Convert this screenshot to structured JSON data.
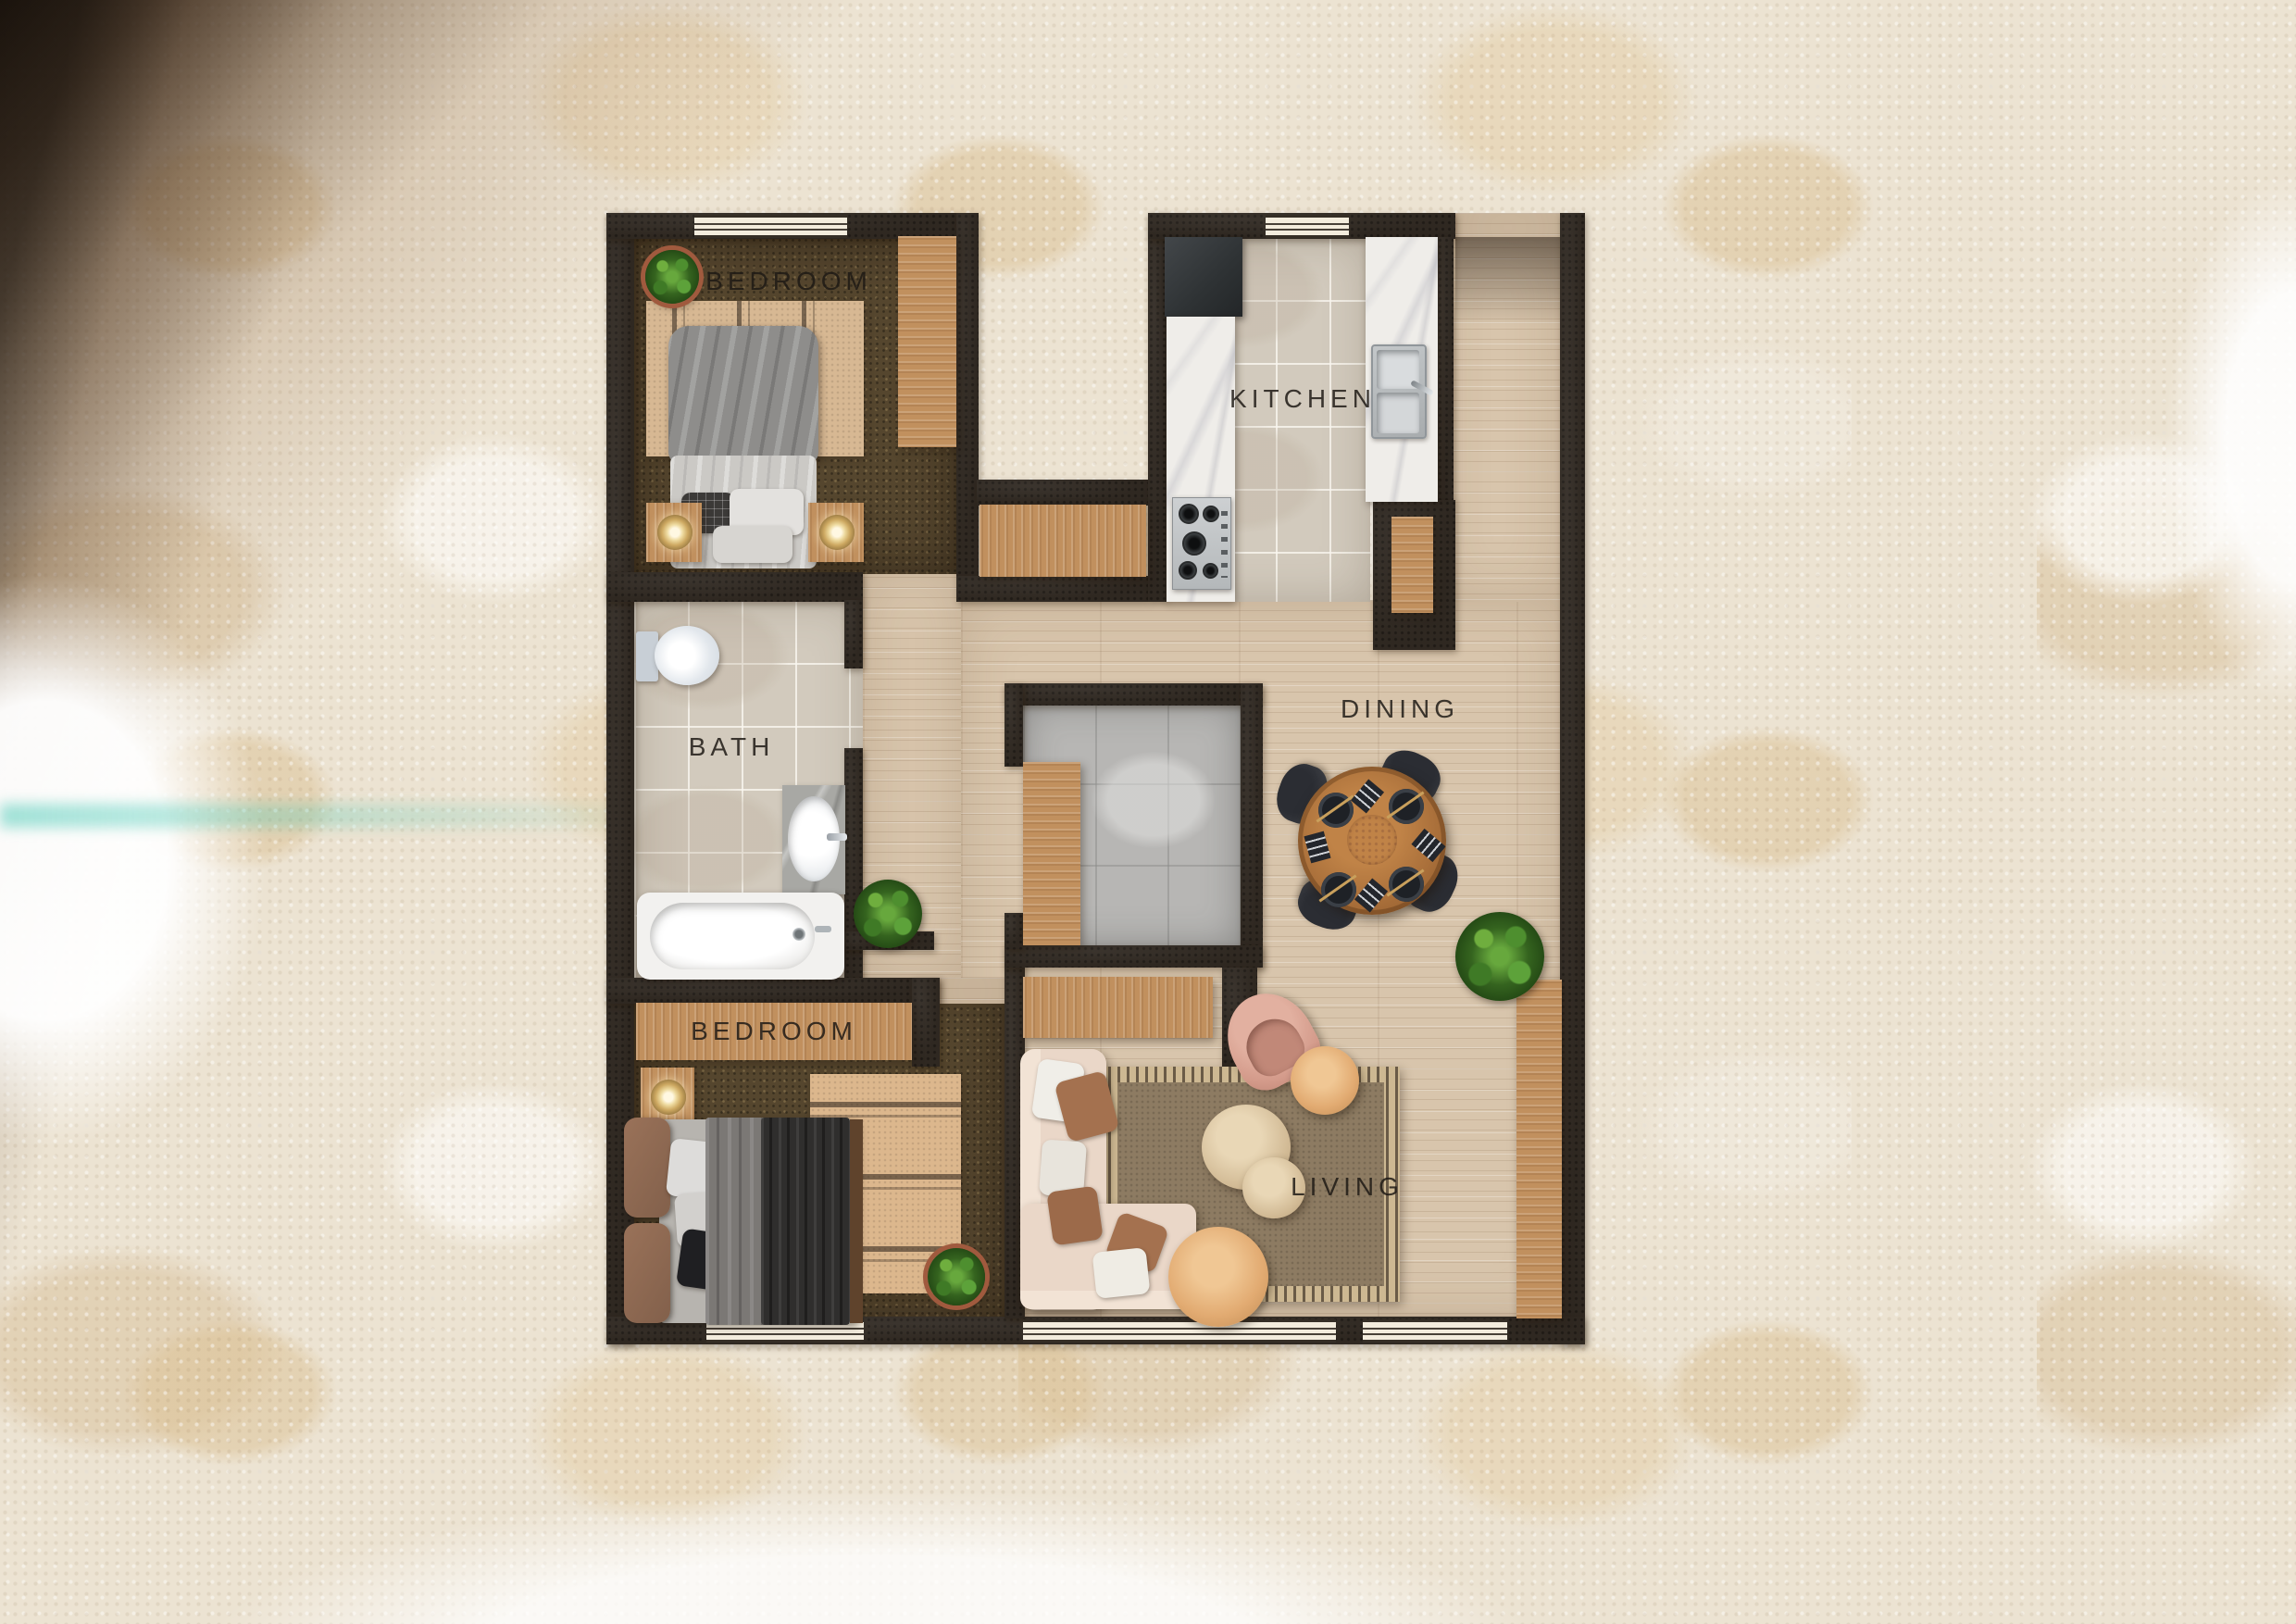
{
  "plan": {
    "type": "apartment-floor-plan-top-view",
    "rooms": [
      {
        "id": "bedroom-top",
        "label": "BEDROOM",
        "floor": "dark-woven-carpet",
        "furniture": [
          "double-bed",
          "zigzag-area-rug",
          "nightstand-left",
          "nightstand-right",
          "table-lamp-left",
          "table-lamp-right",
          "tall-wardrobe",
          "potted-plant"
        ]
      },
      {
        "id": "kitchen",
        "label": "KITCHEN",
        "floor": "stone-tile",
        "furniture": [
          "refrigerator",
          "marble-counter",
          "gas-stove",
          "island-counter",
          "double-sink",
          "base-cabinet"
        ]
      },
      {
        "id": "bath",
        "label": "BATH",
        "floor": "stone-tile",
        "furniture": [
          "toilet",
          "vanity-sink",
          "bathtub"
        ]
      },
      {
        "id": "dining",
        "label": "DINING",
        "floor": "light-wood-plank",
        "furniture": [
          "round-dining-table",
          "dining-chair-1",
          "dining-chair-2",
          "dining-chair-3",
          "dining-chair-4",
          "place-settings",
          "centerpiece"
        ]
      },
      {
        "id": "bedroom-bottom",
        "label": "BEDROOM",
        "floor": "dark-woven-carpet",
        "furniture": [
          "double-bed",
          "zigzag-area-rug",
          "nightstand",
          "table-lamp",
          "long-wardrobe",
          "potted-plant"
        ]
      },
      {
        "id": "living",
        "label": "LIVING",
        "floor": "light-wood-plank",
        "furniture": [
          "l-shaped-sofa",
          "striped-border-rug",
          "pouf-large",
          "pouf-small",
          "armchair",
          "round-side-table",
          "round-coffee-table",
          "tv-console",
          "wall-console",
          "potted-plant"
        ]
      }
    ],
    "hallway": {
      "furniture": [
        "console-shelf",
        "potted-plant"
      ]
    },
    "closet": {
      "floor": "gray-tile",
      "furniture": [
        "built-in-cabinet"
      ]
    },
    "windows_count": 5,
    "palette": {
      "wall": "#2f2821",
      "wood_floor": "#d8c5ac",
      "tile_floor": "#d2cabd",
      "carpet": "#55462e",
      "closet_tile": "#b7b6b4",
      "furniture_wood": "#c1905e",
      "marble": "#efede9",
      "background_plaster": "#ece3d2",
      "background_blotch": "#dcc49f"
    }
  }
}
